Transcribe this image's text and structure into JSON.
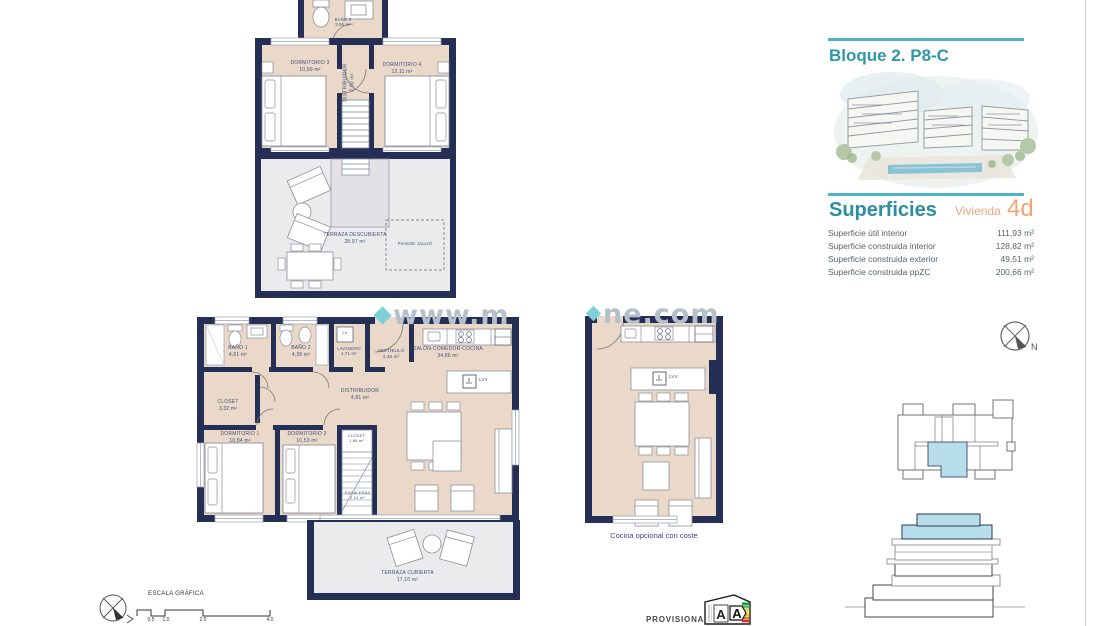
{
  "page": {
    "watermark_left": "www.m",
    "watermark_right": "ne.com"
  },
  "upper_floor": {
    "bano3": {
      "name": "BAÑO 3",
      "area": "3,95 m²"
    },
    "dormitorio3": {
      "name": "DORMITORIO 3",
      "area": "10,99 m²"
    },
    "dormitorio4": {
      "name": "DORMITORIO 4",
      "area": "12,11 m²"
    },
    "distribuidor": {
      "name": "DISTRIBUIDOR",
      "area": "2,90 m²"
    },
    "terraza": {
      "name": "TERRAZA DESCUBIERTA",
      "area": "28,97 m²"
    },
    "jacuzzi_note": "Preinstln Jacuzzi"
  },
  "ground_floor": {
    "bano1": {
      "name": "BAÑO 1",
      "area": "4,61 m²"
    },
    "bano2": {
      "name": "BAÑO 2",
      "area": "4,35 m²"
    },
    "lavadero": {
      "name": "LAVADERO",
      "area": "1,71 m²"
    },
    "lavadero_box_label": "LV",
    "vestibulo": {
      "name": "VESTÍBULO",
      "area": "3,46 m²"
    },
    "salon": {
      "name": "SALÓN-COMEDOR-COCINA",
      "area": "34,86 m²"
    },
    "closet": {
      "name": "CLOSET",
      "area": "3,32 m²"
    },
    "distribuidor": {
      "name": "DISTRIBUIDOR",
      "area": "4,81 m²"
    },
    "dormitorio1": {
      "name": "DORMITORIO 1",
      "area": "10,84 m²"
    },
    "dormitorio2": {
      "name": "DORMITORIO 2",
      "area": "10,53 m²"
    },
    "closet2": {
      "name": "CLOSET",
      "area": "1,86 m²"
    },
    "escaleras": {
      "name": "ESCALERAS",
      "area": "2,10 m²"
    },
    "terraza": {
      "name": "TERRAZA CUBIERTA",
      "area": "17,10 m²"
    },
    "island_label": "LVV"
  },
  "optional_plan": {
    "caption": "Cocina opcional con coste",
    "island_label": "LVV"
  },
  "scale_bar": {
    "title": "ESCALA GRÁFICA",
    "ticks": [
      "0.5",
      "1.0",
      "2.0",
      "4.0"
    ]
  },
  "footer": {
    "provisional": "PROVISIONAL",
    "energy_letter_left": "A",
    "energy_letter_right": "A"
  },
  "info_panel": {
    "title": "Bloque 2. P8-C",
    "superficies_heading": "Superficies",
    "vivienda_label": "Vivienda",
    "vivienda_code": "4d",
    "rows": [
      {
        "label": "Superficie útil interior",
        "value": "111,93 m²"
      },
      {
        "label": "Superficie construida interior",
        "value": "128,82 m²"
      },
      {
        "label": "Superficie construida exterior",
        "value": "49,51 m²"
      },
      {
        "label": "Superficie construida ppZC",
        "value": "200,66 m²"
      }
    ],
    "compass_label": "N"
  },
  "colors": {
    "wall": "#252e55",
    "interior": "#ead9c8",
    "terrace": "#ebebed",
    "teal": "#4db4bf",
    "heading_teal": "#2c8ea4",
    "orange": "#f0a473",
    "highlight_blue": "#b7dcea",
    "label_navy": "#42507e",
    "watermark_gray": "#b6c0ca"
  }
}
